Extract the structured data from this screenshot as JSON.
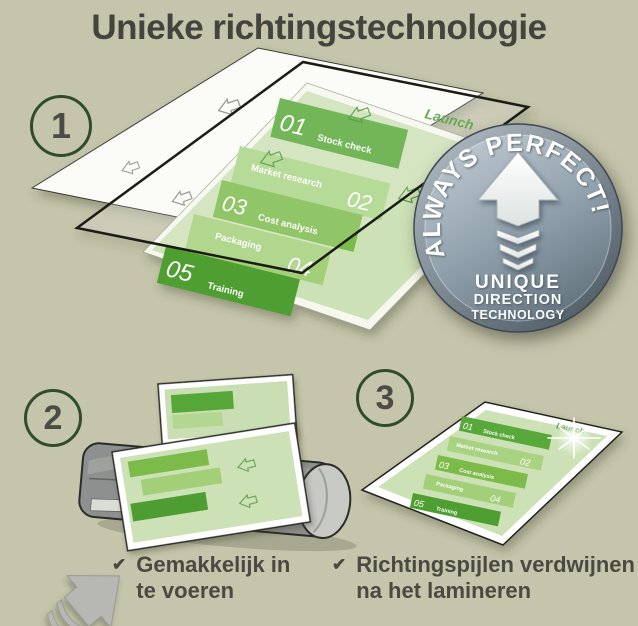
{
  "header": {
    "title": "Unieke richtingstechnologie"
  },
  "steps": {
    "one": "1",
    "two": "2",
    "three": "3"
  },
  "badge": {
    "arc_text": "ALWAYS PERFECT!",
    "line1": "UNIQUE",
    "line2": "DIRECTION",
    "line3": "TECHNOLOGY"
  },
  "document": {
    "launch_label": "Launch",
    "phases": [
      {
        "num": "01",
        "label": "Stock check"
      },
      {
        "num": "02",
        "label": "Market research"
      },
      {
        "num": "03",
        "label": "Cost analysis"
      },
      {
        "num": "04",
        "label": "Packaging"
      },
      {
        "num": "05",
        "label": "Training"
      }
    ]
  },
  "captions": {
    "check_icon": "✔",
    "easy_feed": {
      "line1": "Gemakkelijk in",
      "line2": "te voeren"
    },
    "arrows_disappear": {
      "line1": "Richtingspijlen verdwijnen",
      "line2": "na het lamineren"
    }
  },
  "colors": {
    "background": "#c5c5ab",
    "title_text": "#44443e",
    "step_ring_green": "#2f4d28",
    "page_green_light": "#cde1b6",
    "band_green_dark": "#4f9e33",
    "band_green_mid": "#58a83a",
    "band_green_bright": "#7cbb4a",
    "band_green_pale": "#a9d383",
    "badge_face_gray_blue": "#8fa0ac",
    "laminator_gray": "#8d908e",
    "feed_arrow_gray": "#b7b7b4"
  }
}
